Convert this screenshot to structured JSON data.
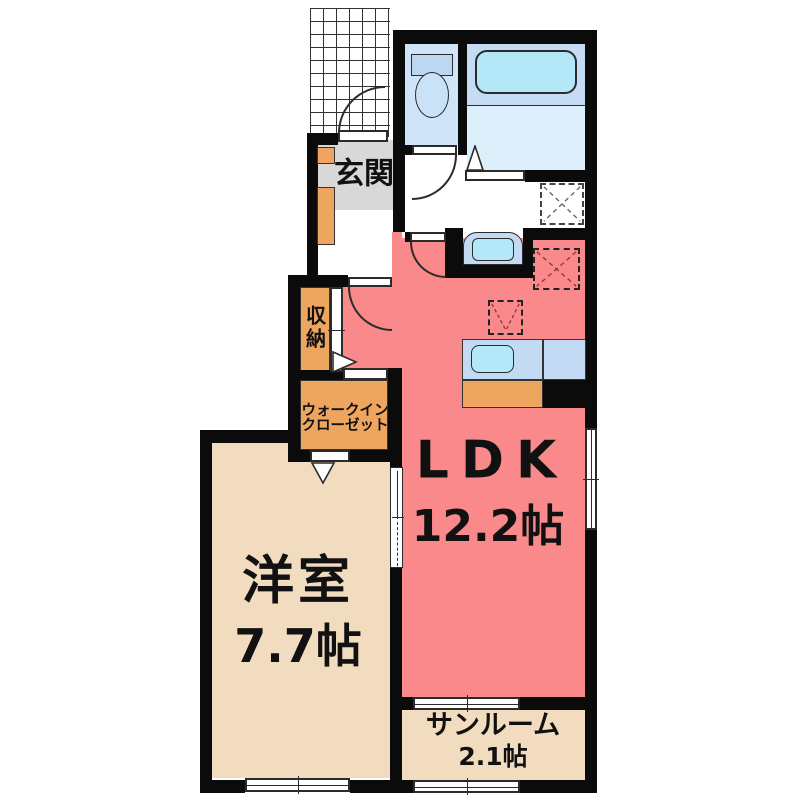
{
  "plan_title": "1LDK apartment floor plan",
  "rooms": {
    "ldk": {
      "name": "LDK",
      "size": "12.2帖"
    },
    "western": {
      "name": "洋室",
      "size": "7.7帖"
    },
    "sunroom": {
      "name": "サンルーム",
      "size": "2.1帖"
    },
    "entrance": {
      "name": "玄関"
    },
    "storage": {
      "name": "収納"
    },
    "wic": {
      "line1": "ウォークイン",
      "line2": "クローゼット"
    }
  },
  "fixtures": [
    "toilet",
    "bathtub",
    "washbasin",
    "kitchen-sink",
    "kitchen-counter",
    "shoe-cabinet",
    "washing-machine-space",
    "refrigerator-space",
    "entrance-porch-tiles"
  ],
  "colors": {
    "ldk_floor": "#f9898b",
    "wood_floor": "#f2dcc0",
    "closet_orange": "#eea55f",
    "entrance_gray": "#d8d8d8",
    "toilet_room_blue": "#cfe4f8",
    "bath_upper_blue": "#c6dcf4",
    "bath_lower_blue": "#ddeffb",
    "water_cyan": "#b2e8f8",
    "counter_blue": "#c2daf3",
    "wall_black": "#0b0b0b"
  }
}
